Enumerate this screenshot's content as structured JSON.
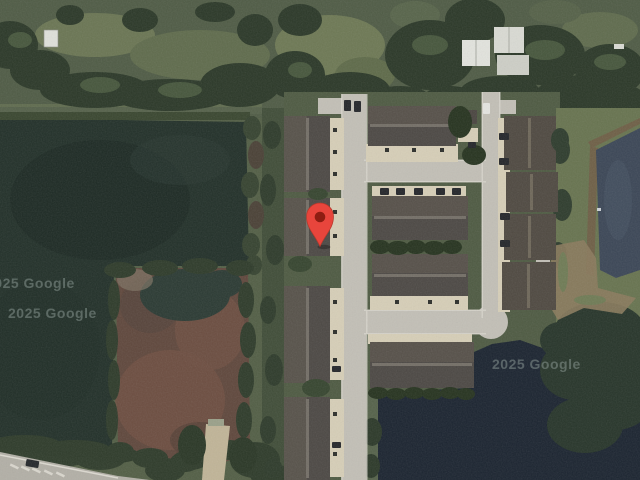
{
  "window": {
    "width": 640,
    "height": 480,
    "title": "Satellite map with dropped pin"
  },
  "map": {
    "view_type": "satellite",
    "attribution": {
      "watermarks": [
        {
          "text": "2025 Google"
        },
        {
          "text": "2025 Google"
        },
        {
          "text": "2025 Google"
        }
      ]
    },
    "marker": {
      "name": "dropped-pin",
      "x": 320,
      "y": 246,
      "body_color": "#E8453C",
      "dot_color": "#8E1D12",
      "outline_color": "#B5392C"
    },
    "palette": {
      "field": "#525E45",
      "trees": "#2B3828",
      "water_pond": "#223029",
      "marsh": "#5F473C",
      "grass_complex": "#4E5A42",
      "street": "#C2BFB6",
      "driveway": "#D6CEB7",
      "roof": "#4C4844",
      "water_lake": "#1B2430",
      "water_east_pond": "#3B4656",
      "highway": "#B2AFA6",
      "bare_earth": "#8A7A5C",
      "watermark_color": "#9AA8A3"
    }
  }
}
